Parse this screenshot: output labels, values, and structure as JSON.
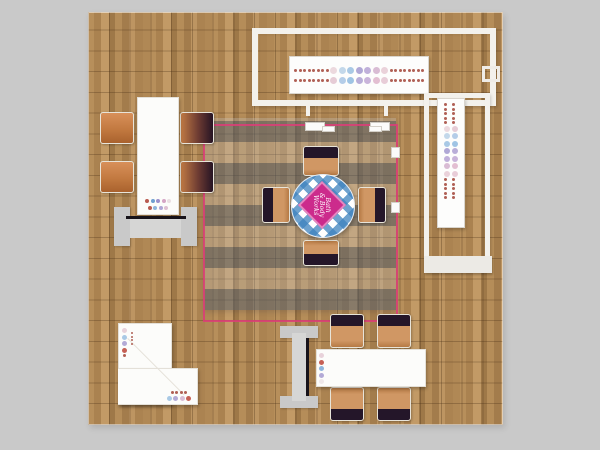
{
  "scene": {
    "description": "Top-down rendering of a square trade show exhibit booth on wood plank flooring",
    "background_color": "#c9c9c9",
    "accent_pink": "#dd3d78",
    "wood_tones": [
      "#c29a66",
      "#ad8452",
      "#9e7848"
    ],
    "canopy_stripe_color": "#525e6c",
    "tablecloth_blue": "#3e82be",
    "chair_orange": "#c27940",
    "chair_dark": "#241629",
    "structure_white": "#f3f1ec"
  },
  "logo": {
    "line1": "Bath",
    "line2": "& Body",
    "line3": "Works",
    "bg": "#cc2b8c",
    "color": "#ffffff"
  },
  "dots": {
    "banner_h_row1": [
      "#b06055:3",
      "#b06055:3",
      "#b06055:3",
      "#b06055:3",
      "#b06055:3",
      "#b06055:3",
      "#b06055:3",
      "#b06055:3",
      "#ecd9de:7",
      "#c3d8ea:7",
      "#a9c9e5:7",
      "#b0a8d6:7",
      "#c0b0da:7",
      "#d9bcd4:7",
      "#ead2da:7",
      "#b06055:3",
      "#b06055:3",
      "#b06055:3",
      "#b06055:3",
      "#b06055:3",
      "#b06055:3",
      "#b06055:3",
      "#b06055:3"
    ],
    "banner_h_row2": [
      "#b06055:3",
      "#b06055:3",
      "#b06055:3",
      "#b06055:3",
      "#b06055:3",
      "#b06055:3",
      "#b06055:3",
      "#b06055:3",
      "#e6ccd6:7",
      "#b4cde8:7",
      "#9fc4e4:7",
      "#b9aed8:7",
      "#c9b4da:7",
      "#e3bfd2:7",
      "#e8cdd8:7",
      "#b06055:3",
      "#b06055:3",
      "#b06055:3",
      "#b06055:3",
      "#b06055:3",
      "#b06055:3",
      "#b06055:3",
      "#b06055:3"
    ],
    "banner_v": [
      "#b06055:3",
      "#b06055:3",
      "#b06055:3",
      "#b06055:3",
      "#b06055:3",
      "#b06055:3",
      "#b06055:3",
      "#b06055:3",
      "#b06055:3",
      "#b06055:3",
      "#ecd9de:6",
      "#e6ccd6:6",
      "#c3d8ea:6",
      "#b4cde8:6",
      "#a9c9e5:6",
      "#9fc4e4:6",
      "#b0a8d6:6",
      "#b9aed8:6",
      "#c0b0da:6",
      "#c9b4da:6",
      "#d9bcd4:6",
      "#e3bfd2:6",
      "#ead2da:6",
      "#e8cdd8:6",
      "#b06055:3",
      "#b06055:3",
      "#b06055:3",
      "#b06055:3",
      "#b06055:3",
      "#b06055:3",
      "#b06055:3",
      "#b06055:3",
      "#b06055:3",
      "#b06055:3"
    ],
    "left_table_row1": [
      "#b85a50:4",
      "#6f9fd0:4",
      "#9b90cc:4",
      "#d5a5c5:4",
      "#eadfe2:4"
    ],
    "left_table_row2": [
      "#b85a50:4",
      "#8fb5dc:4",
      "#b0a6d6:4",
      "#dfc0d2:4"
    ],
    "counter_col": [
      "#e8d2da:5",
      "#a9c9e5:5",
      "#b3aad6:5",
      "#c66055:5",
      "#b06055:3"
    ],
    "counter_tiny_col": [
      "#b06055:2",
      "#b06055:2",
      "#b06055:2",
      "#b06055:2"
    ],
    "counter_row1": [
      "#b06055:3",
      "#b06055:3",
      "#b06055:3",
      "#b06055:3"
    ],
    "counter_row2": [
      "#a9c9e5:5",
      "#b3aad6:5",
      "#d9bcd4:5",
      "#c66055:5"
    ],
    "bottom_table_col": [
      "#e8d2da:5",
      "#c66055:5",
      "#8fb5dc:5",
      "#b3aad6:5",
      "#efe8ea:5"
    ]
  }
}
